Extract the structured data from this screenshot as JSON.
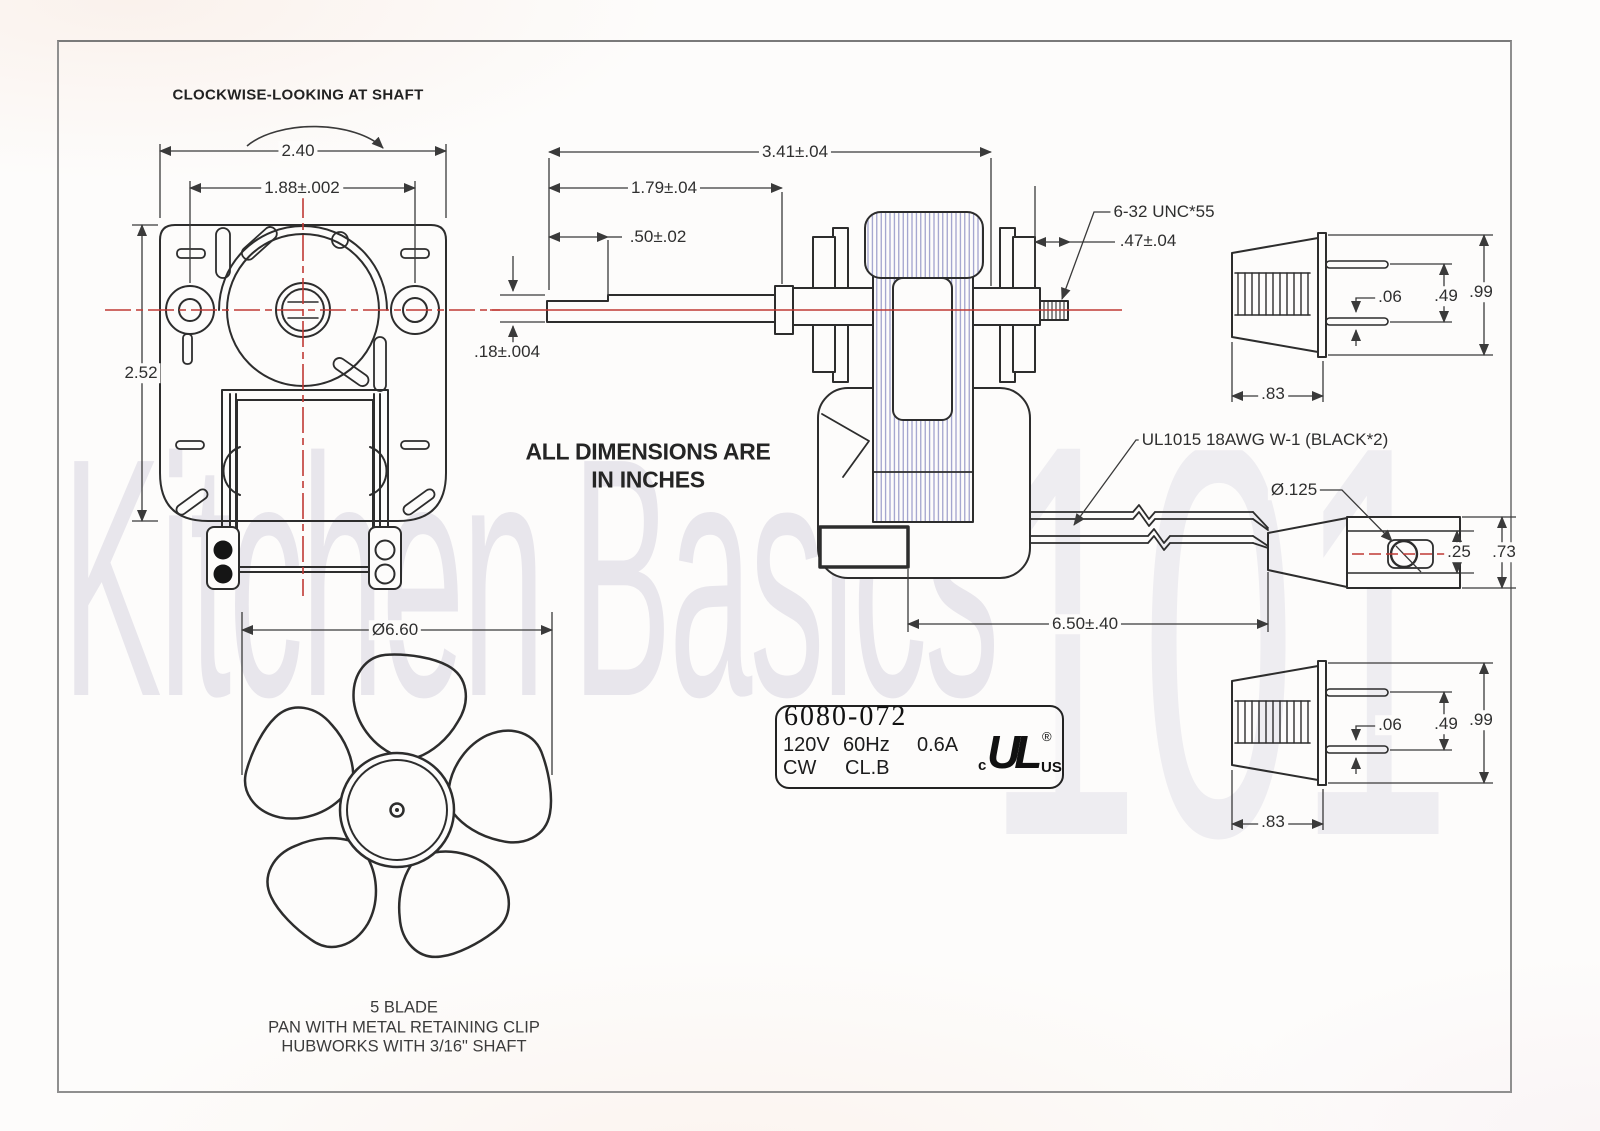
{
  "drawing": {
    "notes": {
      "rotation_note": "CLOCKWISE-LOOKING AT SHAFT",
      "units_note_line1": "ALL DIMENSIONS ARE",
      "units_note_line2": "IN INCHES",
      "wire_spec": "UL1015 18AWG W-1 (BLACK*2)",
      "thread_spec": "6-32 UNC*55"
    },
    "front_view": {
      "overall_width": "2.40",
      "mount_hole_spacing": "1.88±.002",
      "overall_height": "2.52"
    },
    "side_view": {
      "overall_length": "3.41±.04",
      "shaft_length": "1.79±.04",
      "shaft_flat_length": ".50±.02",
      "shaft_diameter": ".18±.004",
      "stud_length": ".47±.04",
      "lead_length": "6.50±.40"
    },
    "plug_top": {
      "pin_thickness": ".06",
      "pin_spacing": ".49",
      "height": ".99",
      "body_length": ".83"
    },
    "plug_bottom": {
      "pin_thickness": ".06",
      "pin_spacing": ".49",
      "height": ".99",
      "body_length": ".83"
    },
    "connector_end": {
      "hole_diameter": "Ø.125",
      "inner_height": ".25",
      "outer_height": ".73"
    },
    "fan": {
      "diameter": "Ø6.60",
      "caption_line1": "5 BLADE",
      "caption_line2": "PAN WITH METAL RETAINING CLIP",
      "caption_line3": "HUBWORKS WITH 3/16\" SHAFT"
    },
    "nameplate": {
      "part_number": "6080-072",
      "voltage": "120V",
      "frequency": "60Hz",
      "current": "0.6A",
      "rotation": "CW",
      "insulation_class": "CL.B",
      "ul_c": "c",
      "ul_mark": "UL",
      "ul_reg": "®",
      "ul_us": "US"
    },
    "watermark": {
      "word1": "Kitchen",
      "word2": "Basics",
      "word3": "101"
    },
    "colors": {
      "line": "#2d2d2d",
      "centerline": "#c03a35",
      "lamination_hatch": "#9193c5",
      "background": "#fdfcfb"
    }
  }
}
